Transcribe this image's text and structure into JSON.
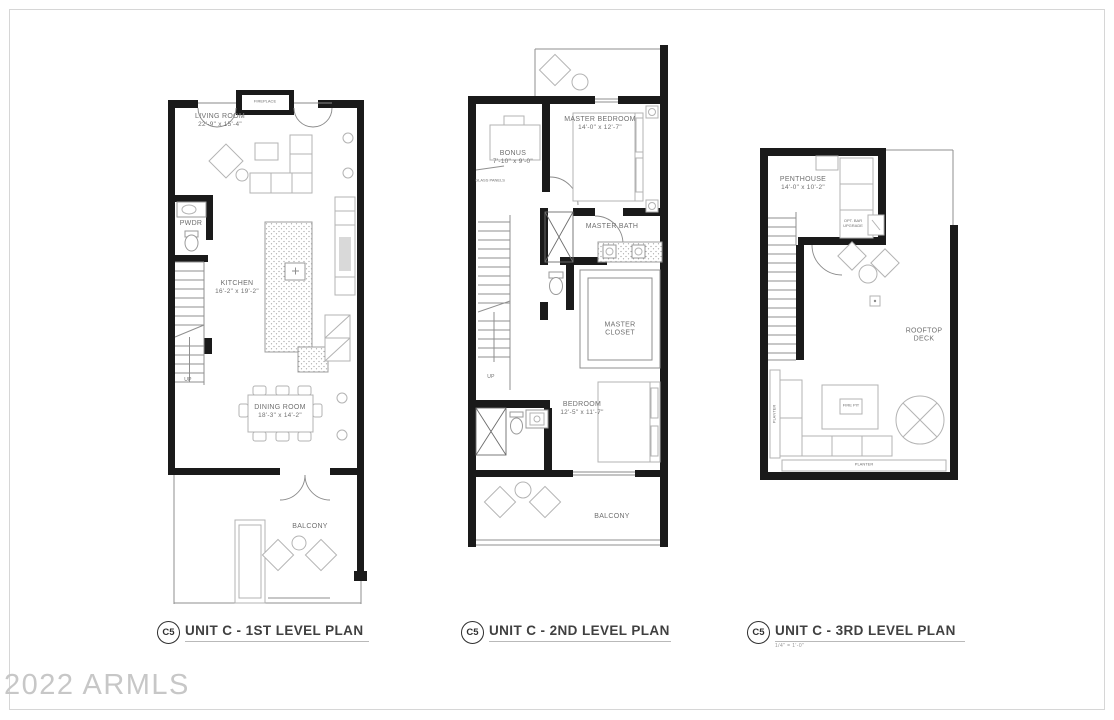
{
  "watermark": "2022 ARMLS",
  "plans": [
    {
      "badge": "C5",
      "title": "UNIT C - 1ST LEVEL PLAN",
      "rooms": {
        "living": {
          "name": "LIVING ROOM",
          "dims": "22'-9\" x 15'-4\""
        },
        "powder": {
          "name": "PWDR"
        },
        "kitchen": {
          "name": "KITCHEN",
          "dims": "16'-2\" x 19'-2\""
        },
        "dining": {
          "name": "DINING ROOM",
          "dims": "18'-3\" x 14'-2\""
        },
        "balcony": {
          "name": "BALCONY"
        }
      },
      "notes": {
        "fireplace": "FIREPLACE",
        "up": "UP"
      }
    },
    {
      "badge": "C5",
      "title": "UNIT C - 2ND LEVEL PLAN",
      "rooms": {
        "bonus": {
          "name": "BONUS",
          "dims": "7'-10\" x 9'-0\""
        },
        "master_bedroom": {
          "name": "MASTER BEDROOM",
          "dims": "14'-0\" x 12'-7\""
        },
        "master_bath": {
          "name": "MASTER BATH"
        },
        "master_closet": {
          "name": "MASTER CLOSET"
        },
        "bedroom": {
          "name": "BEDROOM",
          "dims": "12'-5\" x 11'-7\""
        },
        "balcony": {
          "name": "BALCONY"
        }
      },
      "notes": {
        "glass_panels": "GLASS PANELS",
        "up": "UP"
      }
    },
    {
      "badge": "C5",
      "title": "UNIT C - 3RD LEVEL PLAN",
      "scale": "1/4\" = 1'-0\"",
      "rooms": {
        "penthouse": {
          "name": "PENTHOUSE",
          "dims": "14'-0\" x 10'-2\""
        },
        "rooftop_deck": {
          "name": "ROOFTOP DECK"
        }
      },
      "notes": {
        "opt_bar": "OPT. BAR UPGRADE",
        "fire_pit": "FIRE PIT",
        "planter_left": "PLANTER",
        "planter_bottom": "PLANTER"
      }
    }
  ]
}
